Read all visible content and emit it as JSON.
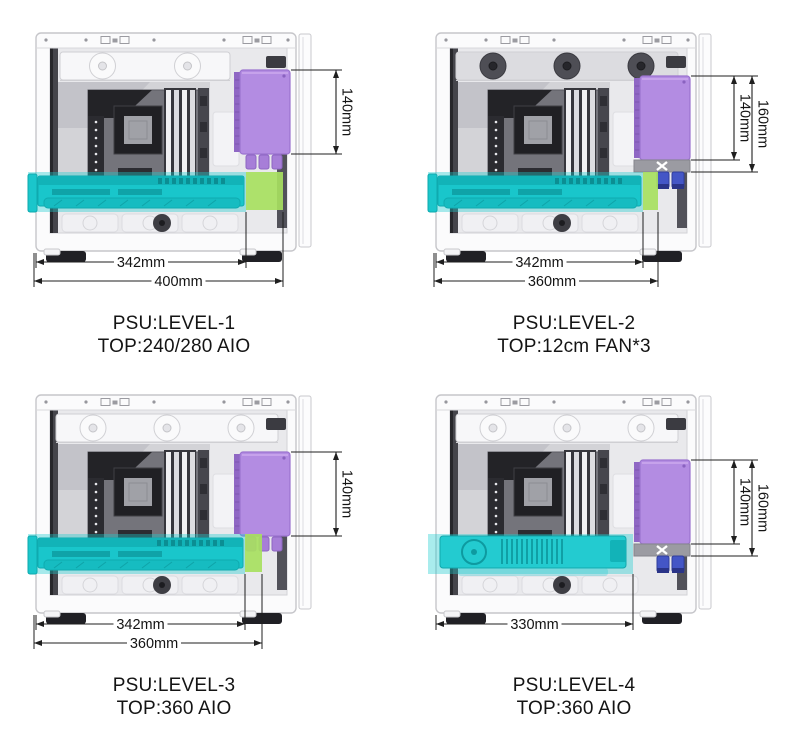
{
  "image_description": "PC case specification diagram showing four PSU mounting levels with clearance dimensions",
  "colors": {
    "background": "#ffffff",
    "case_body": "#fbfbfc",
    "case_border": "#c6c6ca",
    "interior": "#e9e9ec",
    "gpu_teal": "#19c6cb",
    "gpu_highlight_overlay": "rgba(28,204,208,0.38)",
    "clearance_green": "#a7df60",
    "psu_purple": "#b38ce2",
    "psu_purple_dark": "#8f67c4",
    "fan_dark": "#4e4e55",
    "fan_white": "#f7f7f9",
    "xbar_gray": "#9b9ba2",
    "plug_blue": "#4456c6",
    "dimension_line": "#1f1f1f",
    "text": "#141414"
  },
  "panels": [
    {
      "id": "level-1",
      "caption_line1": "PSU:LEVEL-1",
      "caption_line2": "TOP:240/280 AIO",
      "psu_height_dims": [
        "140mm"
      ],
      "depth_dims": [
        "342mm",
        "400mm"
      ],
      "top_fans": {
        "count": 2,
        "style": "white-aio-radiator"
      },
      "psu_position_level": 1,
      "incompatible_mark": false,
      "gpu_card": "long-shrouded"
    },
    {
      "id": "level-2",
      "caption_line1": "PSU:LEVEL-2",
      "caption_line2": "TOP:12cm FAN*3",
      "psu_height_dims": [
        "140mm",
        "160mm"
      ],
      "depth_dims": [
        "342mm",
        "360mm"
      ],
      "top_fans": {
        "count": 3,
        "style": "dark-120mm-fans"
      },
      "psu_position_level": 2,
      "incompatible_mark": true,
      "gpu_card": "long-shrouded"
    },
    {
      "id": "level-3",
      "caption_line1": "PSU:LEVEL-3",
      "caption_line2": "TOP:360 AIO",
      "psu_height_dims": [
        "140mm"
      ],
      "depth_dims": [
        "342mm",
        "360mm"
      ],
      "top_fans": {
        "count": 3,
        "style": "white-aio-radiator"
      },
      "psu_position_level": 3,
      "incompatible_mark": false,
      "gpu_card": "long-shrouded"
    },
    {
      "id": "level-4",
      "caption_line1": "PSU:LEVEL-4",
      "caption_line2": "TOP:360 AIO",
      "psu_height_dims": [
        "140mm",
        "160mm"
      ],
      "depth_dims": [
        "330mm"
      ],
      "top_fans": {
        "count": 3,
        "style": "white-aio-radiator"
      },
      "psu_position_level": 4,
      "incompatible_mark": true,
      "gpu_card": "open-fin"
    }
  ]
}
